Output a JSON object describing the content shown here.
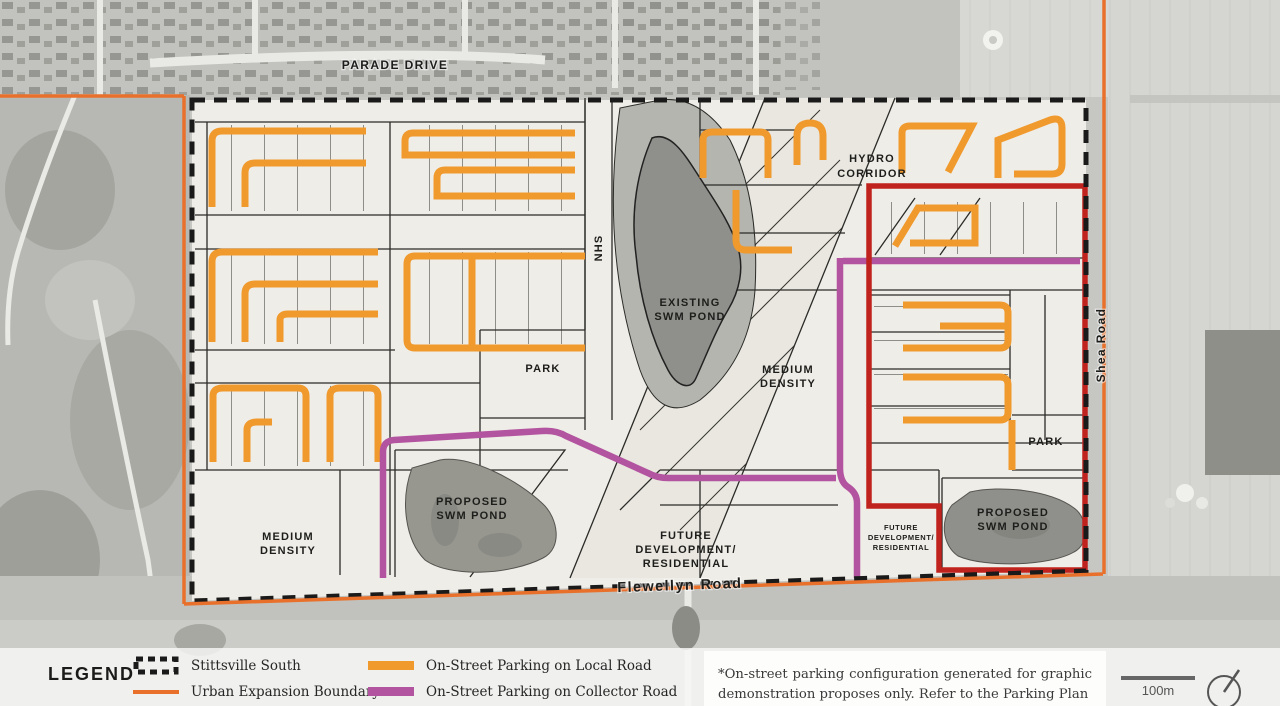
{
  "legend": {
    "title": "LEGEND",
    "items": [
      {
        "id": "stittsville-south",
        "label": "Stittsville South"
      },
      {
        "id": "urban-expansion-boundary",
        "label": "Urban Expansion Boundary"
      },
      {
        "id": "local-road-parking",
        "label": "On-Street Parking on Local Road"
      },
      {
        "id": "collector-road-parking",
        "label": "On-Street Parking on Collector Road"
      }
    ]
  },
  "note": {
    "text": "*On-street parking configuration generated for graphic demonstration proposes only. Refer to the Parking Plan"
  },
  "scale": {
    "label": "100m"
  },
  "map": {
    "road_labels": {
      "parade_drive": "PARADE DRIVE",
      "flewellyn_road": "Flewellyn Road",
      "shea_road": "Shea Road"
    },
    "area_labels": {
      "hydro_corridor": [
        "HYDRO",
        "CORRIDOR"
      ],
      "nhs": "NHS",
      "existing_swm_pond": [
        "EXISTING",
        "SWM POND"
      ],
      "proposed_swm_pond_west": [
        "PROPOSED",
        "SWM POND"
      ],
      "proposed_swm_pond_east": [
        "PROPOSED",
        "SWM POND"
      ],
      "park_west": "PARK",
      "park_east": "PARK",
      "medium_density_center": [
        "MEDIUM",
        "DENSITY"
      ],
      "medium_density_southwest": [
        "MEDIUM",
        "DENSITY"
      ],
      "future_development_center": [
        "FUTURE",
        "DEVELOPMENT/",
        "RESIDENTIAL"
      ],
      "future_development_east": [
        "FUTURE",
        "DEVELOPMENT/",
        "RESIDENTIAL"
      ]
    }
  },
  "colors": {
    "local_parking": "#F0992D",
    "collector_parking": "#B2549F",
    "urban_boundary": "#E8702A",
    "study_boundary": "#1A1A1A",
    "red_boundary": "#C0231E"
  }
}
